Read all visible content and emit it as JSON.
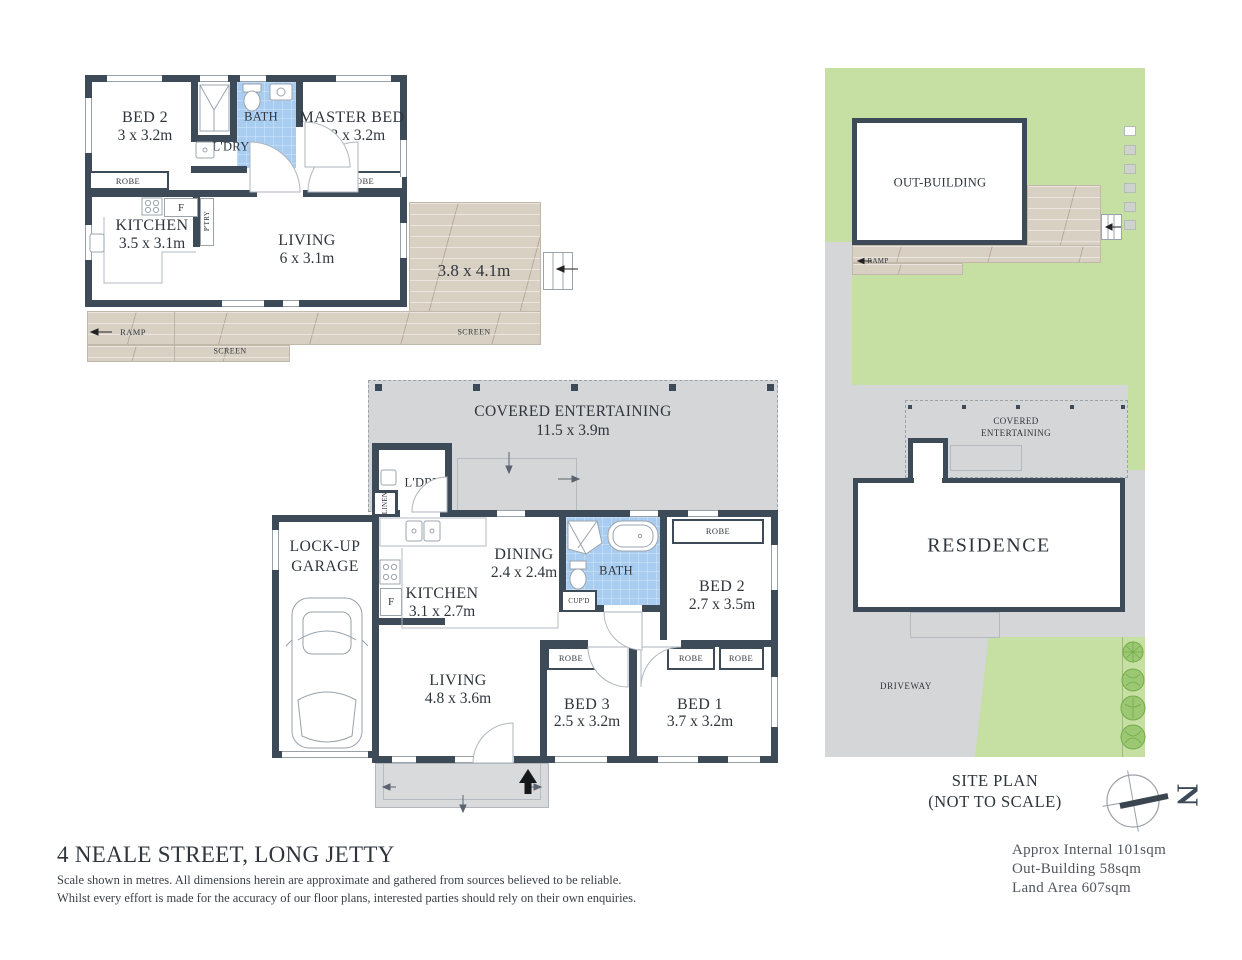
{
  "colors": {
    "wall": "#3d4a57",
    "bath_blue": "#a9cdf0",
    "deck_tan": "#d9d0c4",
    "hardstand_grey": "#d5d6d7",
    "grass_green": "#c6dfa3",
    "text": "#2f353c"
  },
  "labels": {
    "robe": "ROBE",
    "screen": "SCREEN",
    "ramp": "RAMP",
    "fridge": "F",
    "pantry": "P'TRY",
    "laundry": "L'DRY",
    "linen": "LINEN",
    "bath": "BATH",
    "cupboard": "CUP'D",
    "north": "N"
  },
  "outbuilding": {
    "bed2_name": "BED 2",
    "bed2_dims": "3 x 3.2m",
    "master_name": "MASTER BED",
    "master_dims": "3.3 x 3.2m",
    "kitchen_name": "KITCHEN",
    "kitchen_dims": "3.5 x 3.1m",
    "living_name": "LIVING",
    "living_dims": "6 x 3.1m",
    "deck_dims": "3.8 x 4.1m"
  },
  "residence": {
    "covered_name": "COVERED ENTERTAINING",
    "covered_dims": "11.5 x 3.9m",
    "garage_line1": "LOCK-UP",
    "garage_line2": "GARAGE",
    "kitchen_name": "KITCHEN",
    "kitchen_dims": "3.1 x 2.7m",
    "dining_name": "DINING",
    "dining_dims": "2.4 x 2.4m",
    "bed2_name": "BED 2",
    "bed2_dims": "2.7 x 3.5m",
    "bed3_name": "BED 3",
    "bed3_dims": "2.5 x 3.2m",
    "bed1_name": "BED 1",
    "bed1_dims": "3.7 x 3.2m",
    "living_name": "LIVING",
    "living_dims": "4.8 x 3.6m"
  },
  "siteplan": {
    "outbuilding": "OUT-BUILDING",
    "covered_line1": "COVERED",
    "covered_line2": "ENTERTAINING",
    "residence": "RESIDENCE",
    "driveway": "DRIVEWAY",
    "caption_line1": "SITE PLAN",
    "caption_line2": "(NOT TO SCALE)"
  },
  "footer": {
    "address": "4 NEALE STREET, LONG JETTY",
    "disclaimer1": "Scale shown in metres. All dimensions herein are approximate and gathered from sources believed to be  reliable.",
    "disclaimer2": "Whilst every effort is made for the accuracy of our floor plans, interested parties should rely on their own enquiries.",
    "areas": [
      "Approx Internal 101sqm",
      "Out-Building 58sqm",
      "Land Area 607sqm"
    ]
  }
}
